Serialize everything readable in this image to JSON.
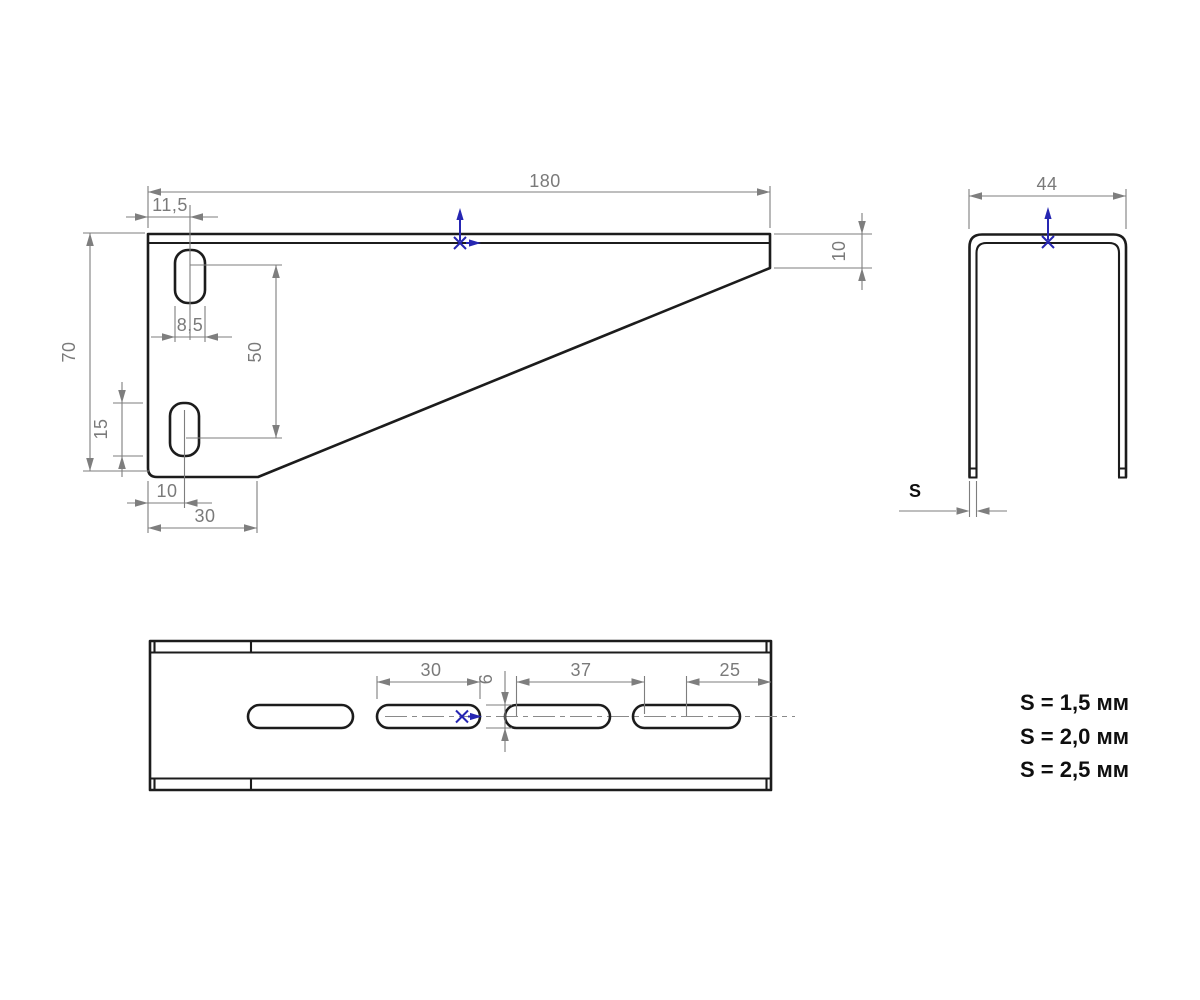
{
  "drawing": {
    "side_view": {
      "length": "180",
      "hole_offset": "11,5",
      "end_height": "10",
      "height": "70",
      "slot_width": "8,5",
      "slot_spacing": "50",
      "slot_length": "15",
      "slot_edge_offset": "10",
      "base_length": "30"
    },
    "front_view": {
      "width": "44",
      "thickness": "S"
    },
    "top_view": {
      "slot_length": "30",
      "slot_width": "6",
      "slot_pitch": "37",
      "end_offset": "25"
    },
    "notes": {
      "s1": "S = 1,5 мм",
      "s2": "S = 2,0 мм",
      "s3": "S = 2,5 мм"
    }
  }
}
